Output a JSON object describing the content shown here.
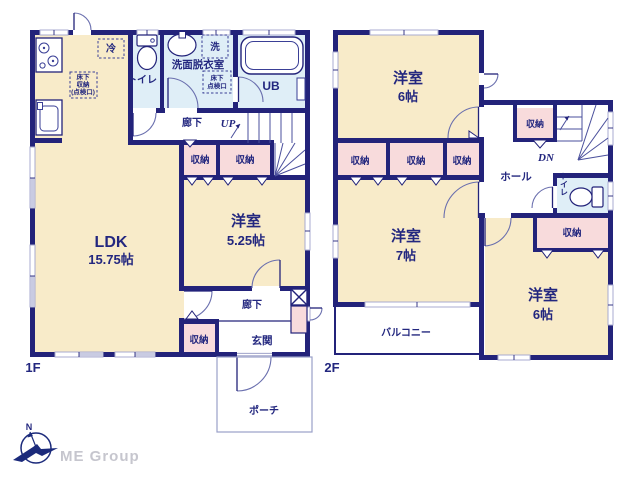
{
  "floor1": {
    "floor_label": "1F",
    "ldk": {
      "name": "LDK",
      "size": "15.75帖"
    },
    "youshitsu": {
      "name": "洋室",
      "size": "5.25帖"
    },
    "toilet": "トイレ",
    "senmen": "洗面脱衣室",
    "washer": "洗",
    "ub": "UB",
    "fridge": "冷",
    "yukashita_lines": [
      "床下",
      "収納",
      "(点検口)"
    ],
    "tenkenkou_lines": [
      "床下",
      "点検口"
    ],
    "hallway_top": "廊下",
    "up": "UP",
    "closet_a": "収納",
    "closet_b": "収納",
    "closet_c": "収納",
    "hallway_bottom": "廊下",
    "entrance": "玄関",
    "porch": "ポーチ"
  },
  "floor2": {
    "floor_label": "2F",
    "room_top": {
      "name": "洋室",
      "size": "6帖"
    },
    "room_mid": {
      "name": "洋室",
      "size": "7帖"
    },
    "room_right": {
      "name": "洋室",
      "size": "6帖"
    },
    "closet_1": "収納",
    "closet_2": "収納",
    "closet_3": "収納",
    "closet_hall": "収納",
    "closet_right": "収納",
    "hall": "ホール",
    "dn": "DN",
    "toilet": "トイレ",
    "balcony": "バルコニー"
  },
  "logo": {
    "company": "ME Group",
    "compass_north": "N"
  },
  "colors": {
    "wall": "#23237a",
    "room_cream": "#f8ebc9",
    "closet_pink": "#f8dbdc",
    "wet_area_blue": "#dfeef7",
    "text_navy": "#23277f",
    "window_rail": "#a9abd0",
    "logo_gray": "#c6c6ce"
  }
}
